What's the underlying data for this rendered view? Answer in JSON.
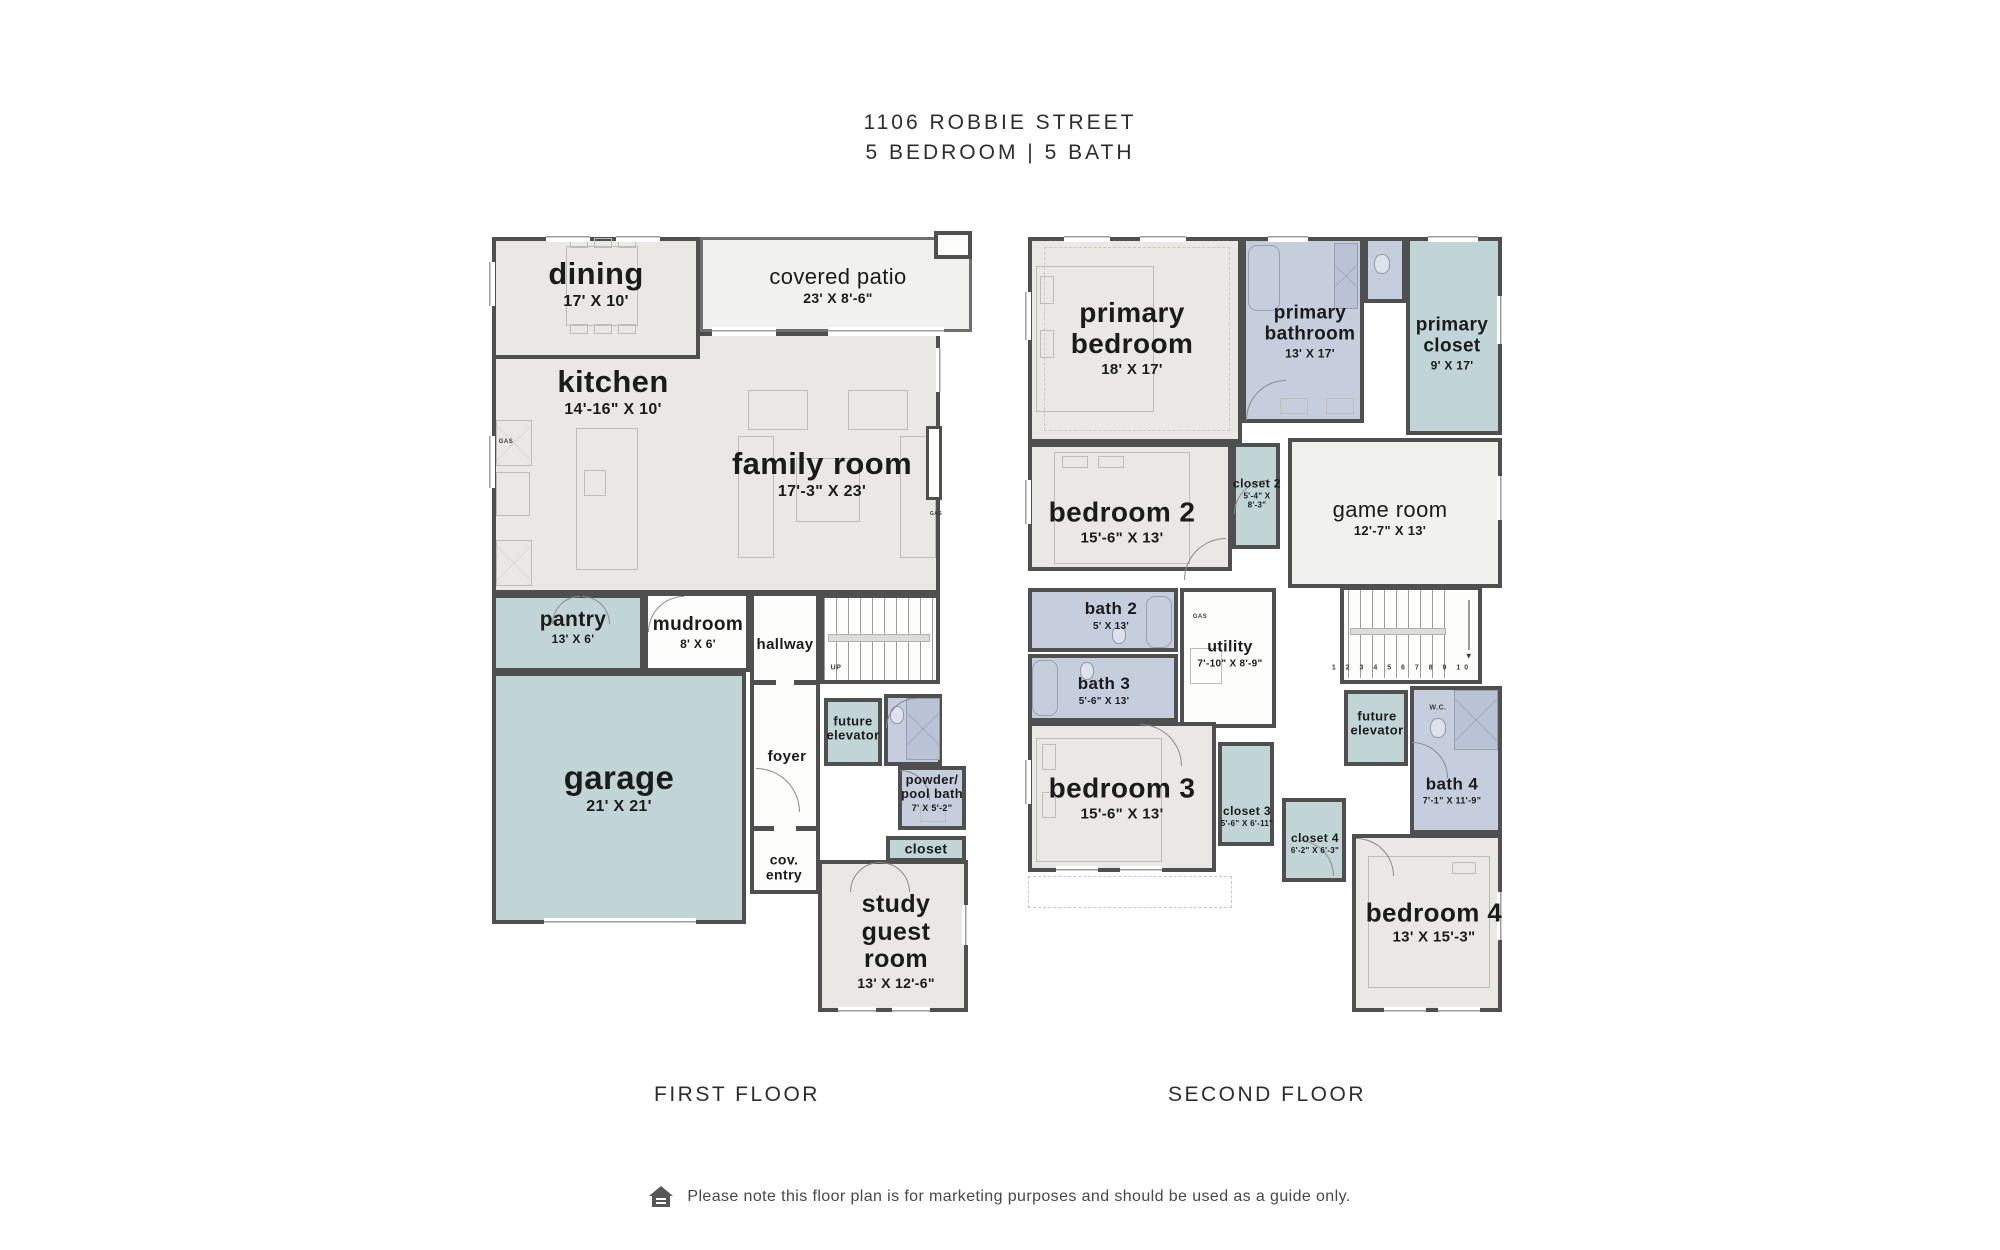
{
  "title": {
    "line1": "1106 ROBBIE STREET",
    "line2": "5 BEDROOM | 5 BATH"
  },
  "footer": {
    "note": "Please note this floor plan is for marketing purposes and should be used as a guide only."
  },
  "annotations": {
    "gas": "GAS",
    "wc": "W.C.",
    "up": "UP",
    "stair_numbers": "1 2 3 4 5 6 7 8 9 10",
    "down_arrow": "▼"
  },
  "colors": {
    "wall": "#4f4f4f",
    "room_gray": "#e9e8e5",
    "room_teal": "#c1d5d6",
    "room_blue": "#c6cedd",
    "room_light": "#f1f1ee"
  },
  "floors": {
    "first": {
      "label": "FIRST FLOOR",
      "rooms": {
        "dining": {
          "name": "dining",
          "dims": "17' X 10'"
        },
        "covered_patio": {
          "name": "covered patio",
          "dims": "23' X 8'-6\""
        },
        "kitchen": {
          "name": "kitchen",
          "dims": "14'-16\" X 10'"
        },
        "family_room": {
          "name": "family room",
          "dims": "17'-3\" X 23'"
        },
        "pantry": {
          "name": "pantry",
          "dims": "13' X 6'"
        },
        "mudroom": {
          "name": "mudroom",
          "dims": "8' X 6'"
        },
        "hallway": {
          "name": "hallway"
        },
        "garage": {
          "name": "garage",
          "dims": "21' X 21'"
        },
        "foyer": {
          "name": "foyer"
        },
        "future_elevator": {
          "name": "future elevator"
        },
        "powder_pool_bath": {
          "name": "powder/ pool bath",
          "dims": "7' X 5'-2\""
        },
        "closet": {
          "name": "closet"
        },
        "cov_entry": {
          "name": "cov. entry"
        },
        "study_guest_room": {
          "name": "study guest room",
          "dims": "13' X 12'-6\""
        }
      }
    },
    "second": {
      "label": "SECOND FLOOR",
      "rooms": {
        "primary_bedroom": {
          "name": "primary bedroom",
          "dims": "18' X 17'"
        },
        "primary_bathroom": {
          "name": "primary bathroom",
          "dims": "13' X 17'"
        },
        "primary_closet": {
          "name": "primary closet",
          "dims": "9' X 17'"
        },
        "bedroom_2": {
          "name": "bedroom 2",
          "dims": "15'-6\" X 13'"
        },
        "closet_2": {
          "name": "closet 2",
          "dims": "5'-4\" X 8'-3\""
        },
        "game_room": {
          "name": "game room",
          "dims": "12'-7\" X 13'"
        },
        "bath_2": {
          "name": "bath 2",
          "dims": "5' X 13'"
        },
        "bath_3": {
          "name": "bath 3",
          "dims": "5'-6\" X 13'"
        },
        "utility": {
          "name": "utility",
          "dims": "7'-10\" X 8'-9\""
        },
        "bedroom_3": {
          "name": "bedroom 3",
          "dims": "15'-6\" X 13'"
        },
        "closet_3": {
          "name": "closet 3",
          "dims": "5'-6\" X 6'-11\""
        },
        "closet_4": {
          "name": "closet 4",
          "dims": "6'-2\" X 6'-3\""
        },
        "future_elevator": {
          "name": "future elevator"
        },
        "bath_4": {
          "name": "bath 4",
          "dims": "7'-1\" X 11'-9\""
        },
        "bedroom_4": {
          "name": "bedroom 4",
          "dims": "13' X 15'-3\""
        }
      }
    }
  }
}
